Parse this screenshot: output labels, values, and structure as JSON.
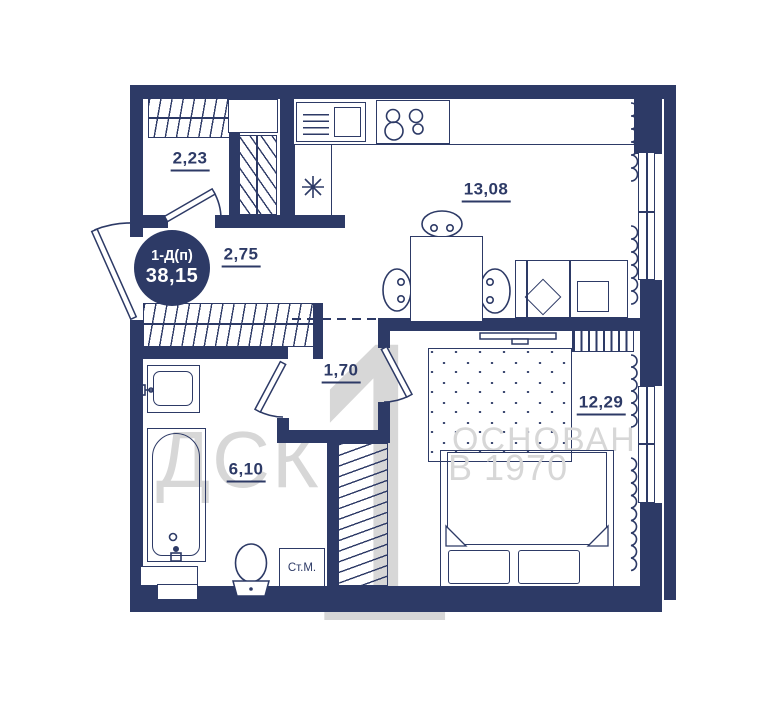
{
  "plan": {
    "badge": {
      "type": "1-Д(п)",
      "area": "38,15"
    },
    "rooms": {
      "entry_room": "2,23",
      "hallway": "2,75",
      "kitchen_living": "13,08",
      "inner_hall": "1,70",
      "bathroom": "6,10",
      "bedroom": "12,29"
    },
    "appliances": {
      "washing_machine": "Ст.М."
    },
    "watermark": {
      "company": "ДСК",
      "numeral": "1",
      "line1": "ОСНОВАН",
      "line2": "В 1970"
    },
    "colors": {
      "wall": "#2d3a66",
      "watermark": "#d7d7d7",
      "background": "#ffffff"
    }
  }
}
